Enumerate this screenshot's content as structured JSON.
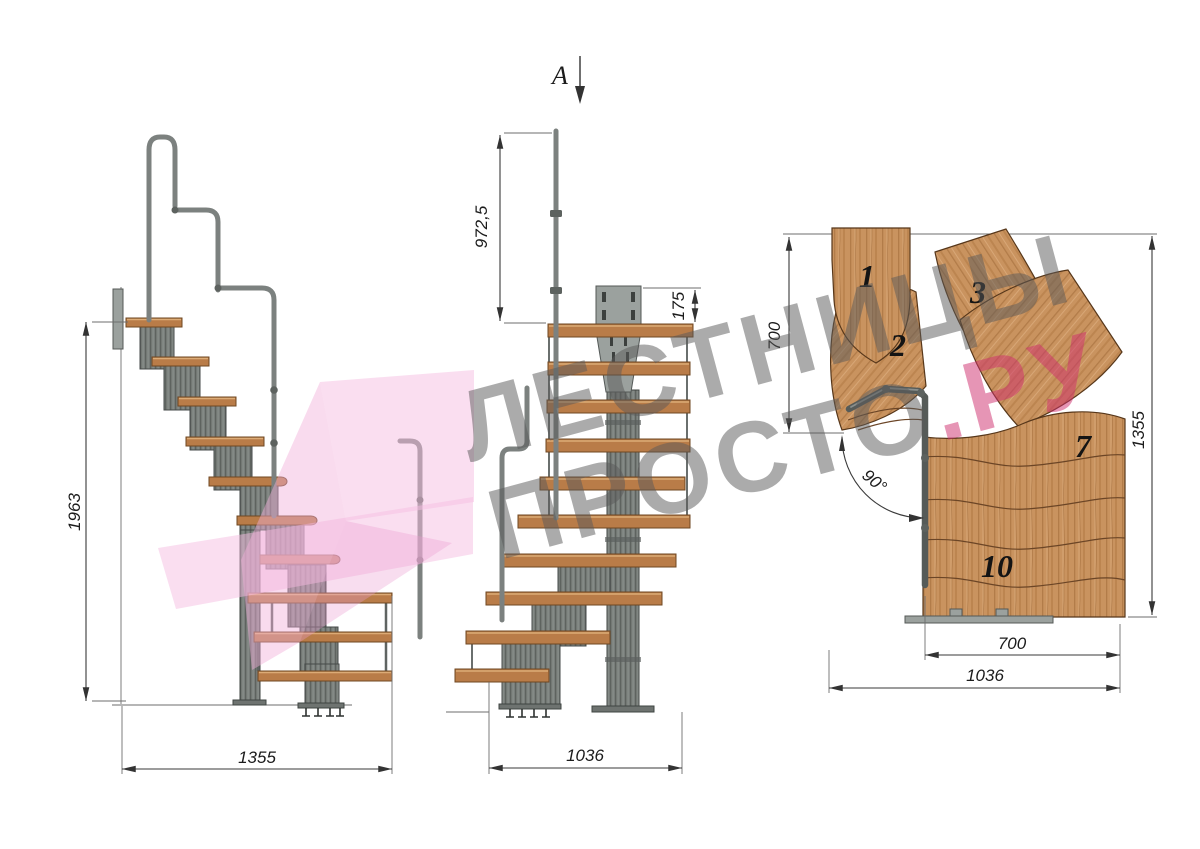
{
  "drawing": {
    "description": "Modular staircase technical drawing with side elevation, front elevation (section A) and plan view"
  },
  "side_view": {
    "dim_total_height": "1963",
    "dim_total_length": "1355"
  },
  "front_view": {
    "section_label": "A",
    "dim_handrail_height": "972,5",
    "dim_mount_plate_height": "175",
    "dim_total_width": "1036"
  },
  "plan_view": {
    "dim_upper_flight_depth": "700",
    "dim_total_depth": "1355",
    "dim_lower_flight_width": "700",
    "dim_total_width": "1036",
    "dim_turn_angle": "90°",
    "step_numbers": [
      "1",
      "2",
      "3",
      "7",
      "10"
    ]
  },
  "watermark": {
    "line1": "ЛЕСТНИЦЫ",
    "line2_gray": "ПРОСТО",
    "line2_accent": ".РУ",
    "text_color": "#ababab",
    "accent_color": "#cf2e6e",
    "logo_color": "#f6bde2"
  },
  "colors": {
    "background": "#ffffff",
    "wood": "#c9935f",
    "wood_outline": "#57371a",
    "steel": "#757a77",
    "steel_dark": "#454a48",
    "dimension_lines": "#3a3a3a"
  }
}
